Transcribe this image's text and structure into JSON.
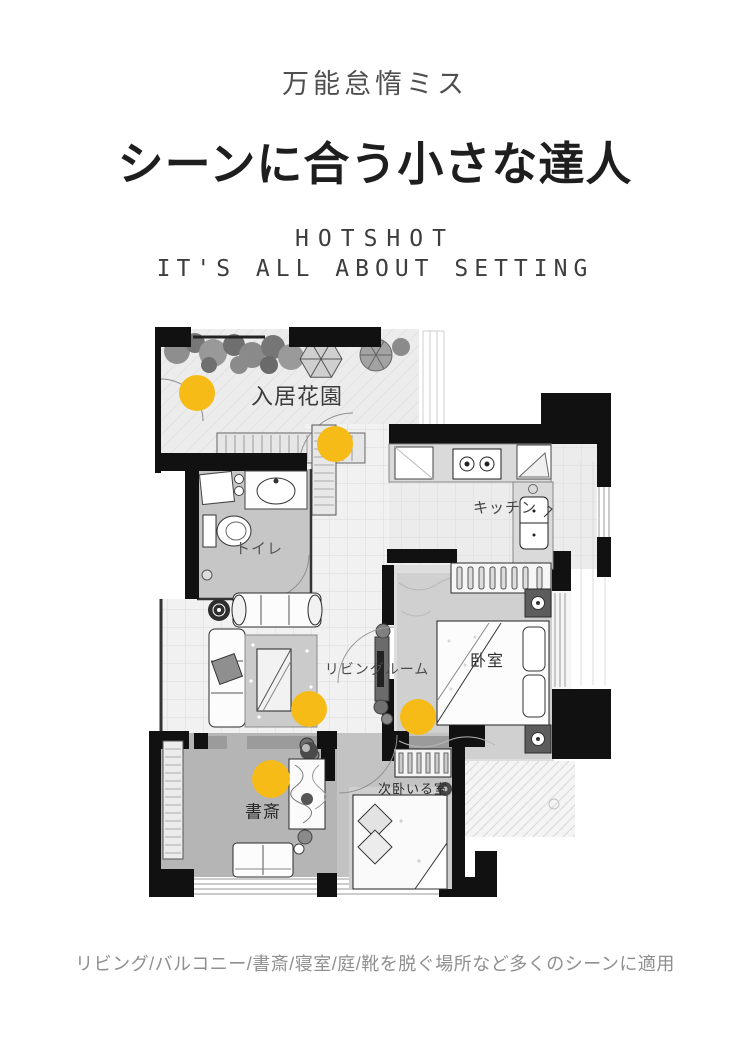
{
  "header": {
    "subtitle": "万能怠惰ミス",
    "title": "シーンに合う小さな達人",
    "brand": "HOTSHOT",
    "tagline": "IT'S ALL ABOUT SETTING"
  },
  "floorplan": {
    "accent_color": "#F6BB17",
    "rooms": [
      {
        "id": "garden",
        "label": "入居花園"
      },
      {
        "id": "kitchen",
        "label": "キッチン"
      },
      {
        "id": "toilet",
        "label": "トイレ"
      },
      {
        "id": "living",
        "label": "リビングルーム"
      },
      {
        "id": "bedroom",
        "label": "卧室"
      },
      {
        "id": "study",
        "label": "書斎"
      },
      {
        "id": "bedroom2",
        "label": "次卧いる室"
      }
    ],
    "markers": [
      "garden-spot",
      "entrance-spot",
      "living-spot",
      "bedroom-door-spot",
      "study-spot"
    ]
  },
  "footer": {
    "caption": "リビング/バルコニー/書斎/寝室/庭/靴を脱ぐ場所など多くのシーンに適用"
  }
}
